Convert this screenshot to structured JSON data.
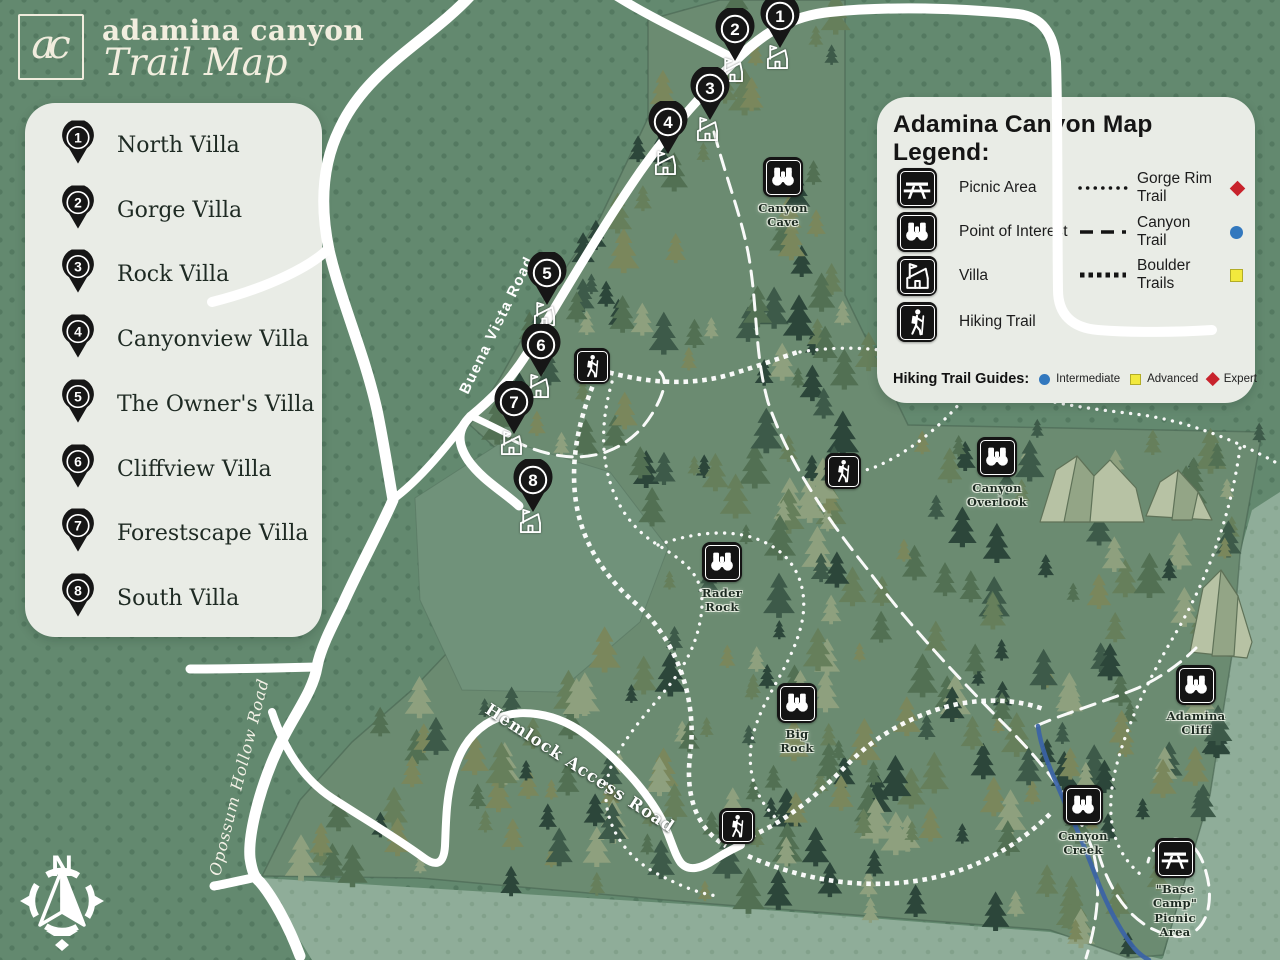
{
  "header": {
    "logo_monogram": "ac",
    "title": "adamina canyon",
    "subtitle": "Trail Map"
  },
  "villa_list": {
    "items": [
      {
        "number": "1",
        "name": "North Villa"
      },
      {
        "number": "2",
        "name": "Gorge Villa"
      },
      {
        "number": "3",
        "name": "Rock Villa"
      },
      {
        "number": "4",
        "name": "Canyonview Villa"
      },
      {
        "number": "5",
        "name": "The Owner's Villa"
      },
      {
        "number": "6",
        "name": "Cliffview Villa"
      },
      {
        "number": "7",
        "name": "Forestscape Villa"
      },
      {
        "number": "8",
        "name": "South Villa"
      }
    ]
  },
  "legend": {
    "title": "Adamina Canyon Map Legend:",
    "point_items": [
      {
        "icon": "picnic-table",
        "label": "Picnic Area"
      },
      {
        "icon": "binoculars",
        "label": "Point of Interest"
      },
      {
        "icon": "villa-house",
        "label": "Villa"
      },
      {
        "icon": "hiker",
        "label": "Hiking Trail"
      }
    ],
    "trail_items": [
      {
        "style": "dotted",
        "label": "Gorge Rim Trail",
        "marker": "diamond",
        "color": "#C8232C"
      },
      {
        "style": "dashed",
        "label": "Canyon Trail",
        "marker": "circle",
        "color": "#3278BE"
      },
      {
        "style": "boulder",
        "label": "Boulder Trails",
        "marker": "square",
        "color": "#F2E93D"
      }
    ],
    "guides": {
      "title": "Hiking Trail Guides:",
      "items": [
        {
          "shape": "circle",
          "color": "#3278BE",
          "label": "Intermediate"
        },
        {
          "shape": "square",
          "color": "#F2E93D",
          "label": "Advanced"
        },
        {
          "shape": "diamond",
          "color": "#C8232C",
          "label": "Expert"
        }
      ]
    }
  },
  "map": {
    "compass_label": "N",
    "villa_markers": [
      {
        "number": "1",
        "x": 780,
        "y": 16
      },
      {
        "number": "2",
        "x": 735,
        "y": 29
      },
      {
        "number": "3",
        "x": 710,
        "y": 88
      },
      {
        "number": "4",
        "x": 668,
        "y": 122
      },
      {
        "number": "5",
        "x": 547,
        "y": 273
      },
      {
        "number": "6",
        "x": 541,
        "y": 345
      },
      {
        "number": "7",
        "x": 514,
        "y": 402
      },
      {
        "number": "8",
        "x": 533,
        "y": 480
      }
    ],
    "poi_markers": [
      {
        "icon": "binoculars",
        "label": "Canyon\nCave",
        "x": 783,
        "y": 177
      },
      {
        "icon": "binoculars",
        "label": "Canyon\nOverlook",
        "x": 997,
        "y": 457
      },
      {
        "icon": "binoculars",
        "label": "Rader\nRock",
        "x": 722,
        "y": 562
      },
      {
        "icon": "binoculars",
        "label": "Big\nRock",
        "x": 797,
        "y": 703
      },
      {
        "icon": "binoculars",
        "label": "Adamina\nCliff",
        "x": 1196,
        "y": 685
      },
      {
        "icon": "binoculars",
        "label": "Canyon\nCreek",
        "x": 1083,
        "y": 805
      },
      {
        "icon": "picnic-table",
        "label": "\"Base Camp\"\nPicnic Area",
        "x": 1175,
        "y": 858
      }
    ],
    "hiker_markers": [
      {
        "x": 592,
        "y": 366
      },
      {
        "x": 843,
        "y": 471
      },
      {
        "x": 737,
        "y": 826
      }
    ],
    "road_labels": [
      {
        "text": "Buena Vista Road",
        "x": 497,
        "y": 325,
        "angle": -64,
        "style": "sans"
      },
      {
        "text": "Hemlock Access Road",
        "x": 580,
        "y": 768,
        "angle": 33,
        "style": "serif-outline"
      },
      {
        "text": "Opossum Hollow Road",
        "x": 239,
        "y": 777,
        "angle": -76,
        "style": "serif-italic"
      }
    ]
  },
  "colors": {
    "background": "#63896F",
    "forest": "#6B8B71",
    "light_area": "#8FAD99",
    "panel": "#E9ECE6",
    "road": "#FFFFFF",
    "marker_black": "#161616",
    "creek_blue": "#3B63A6",
    "intermediate_blue": "#3278BE",
    "advanced_yellow": "#F2E93D",
    "expert_red": "#C8232C"
  }
}
